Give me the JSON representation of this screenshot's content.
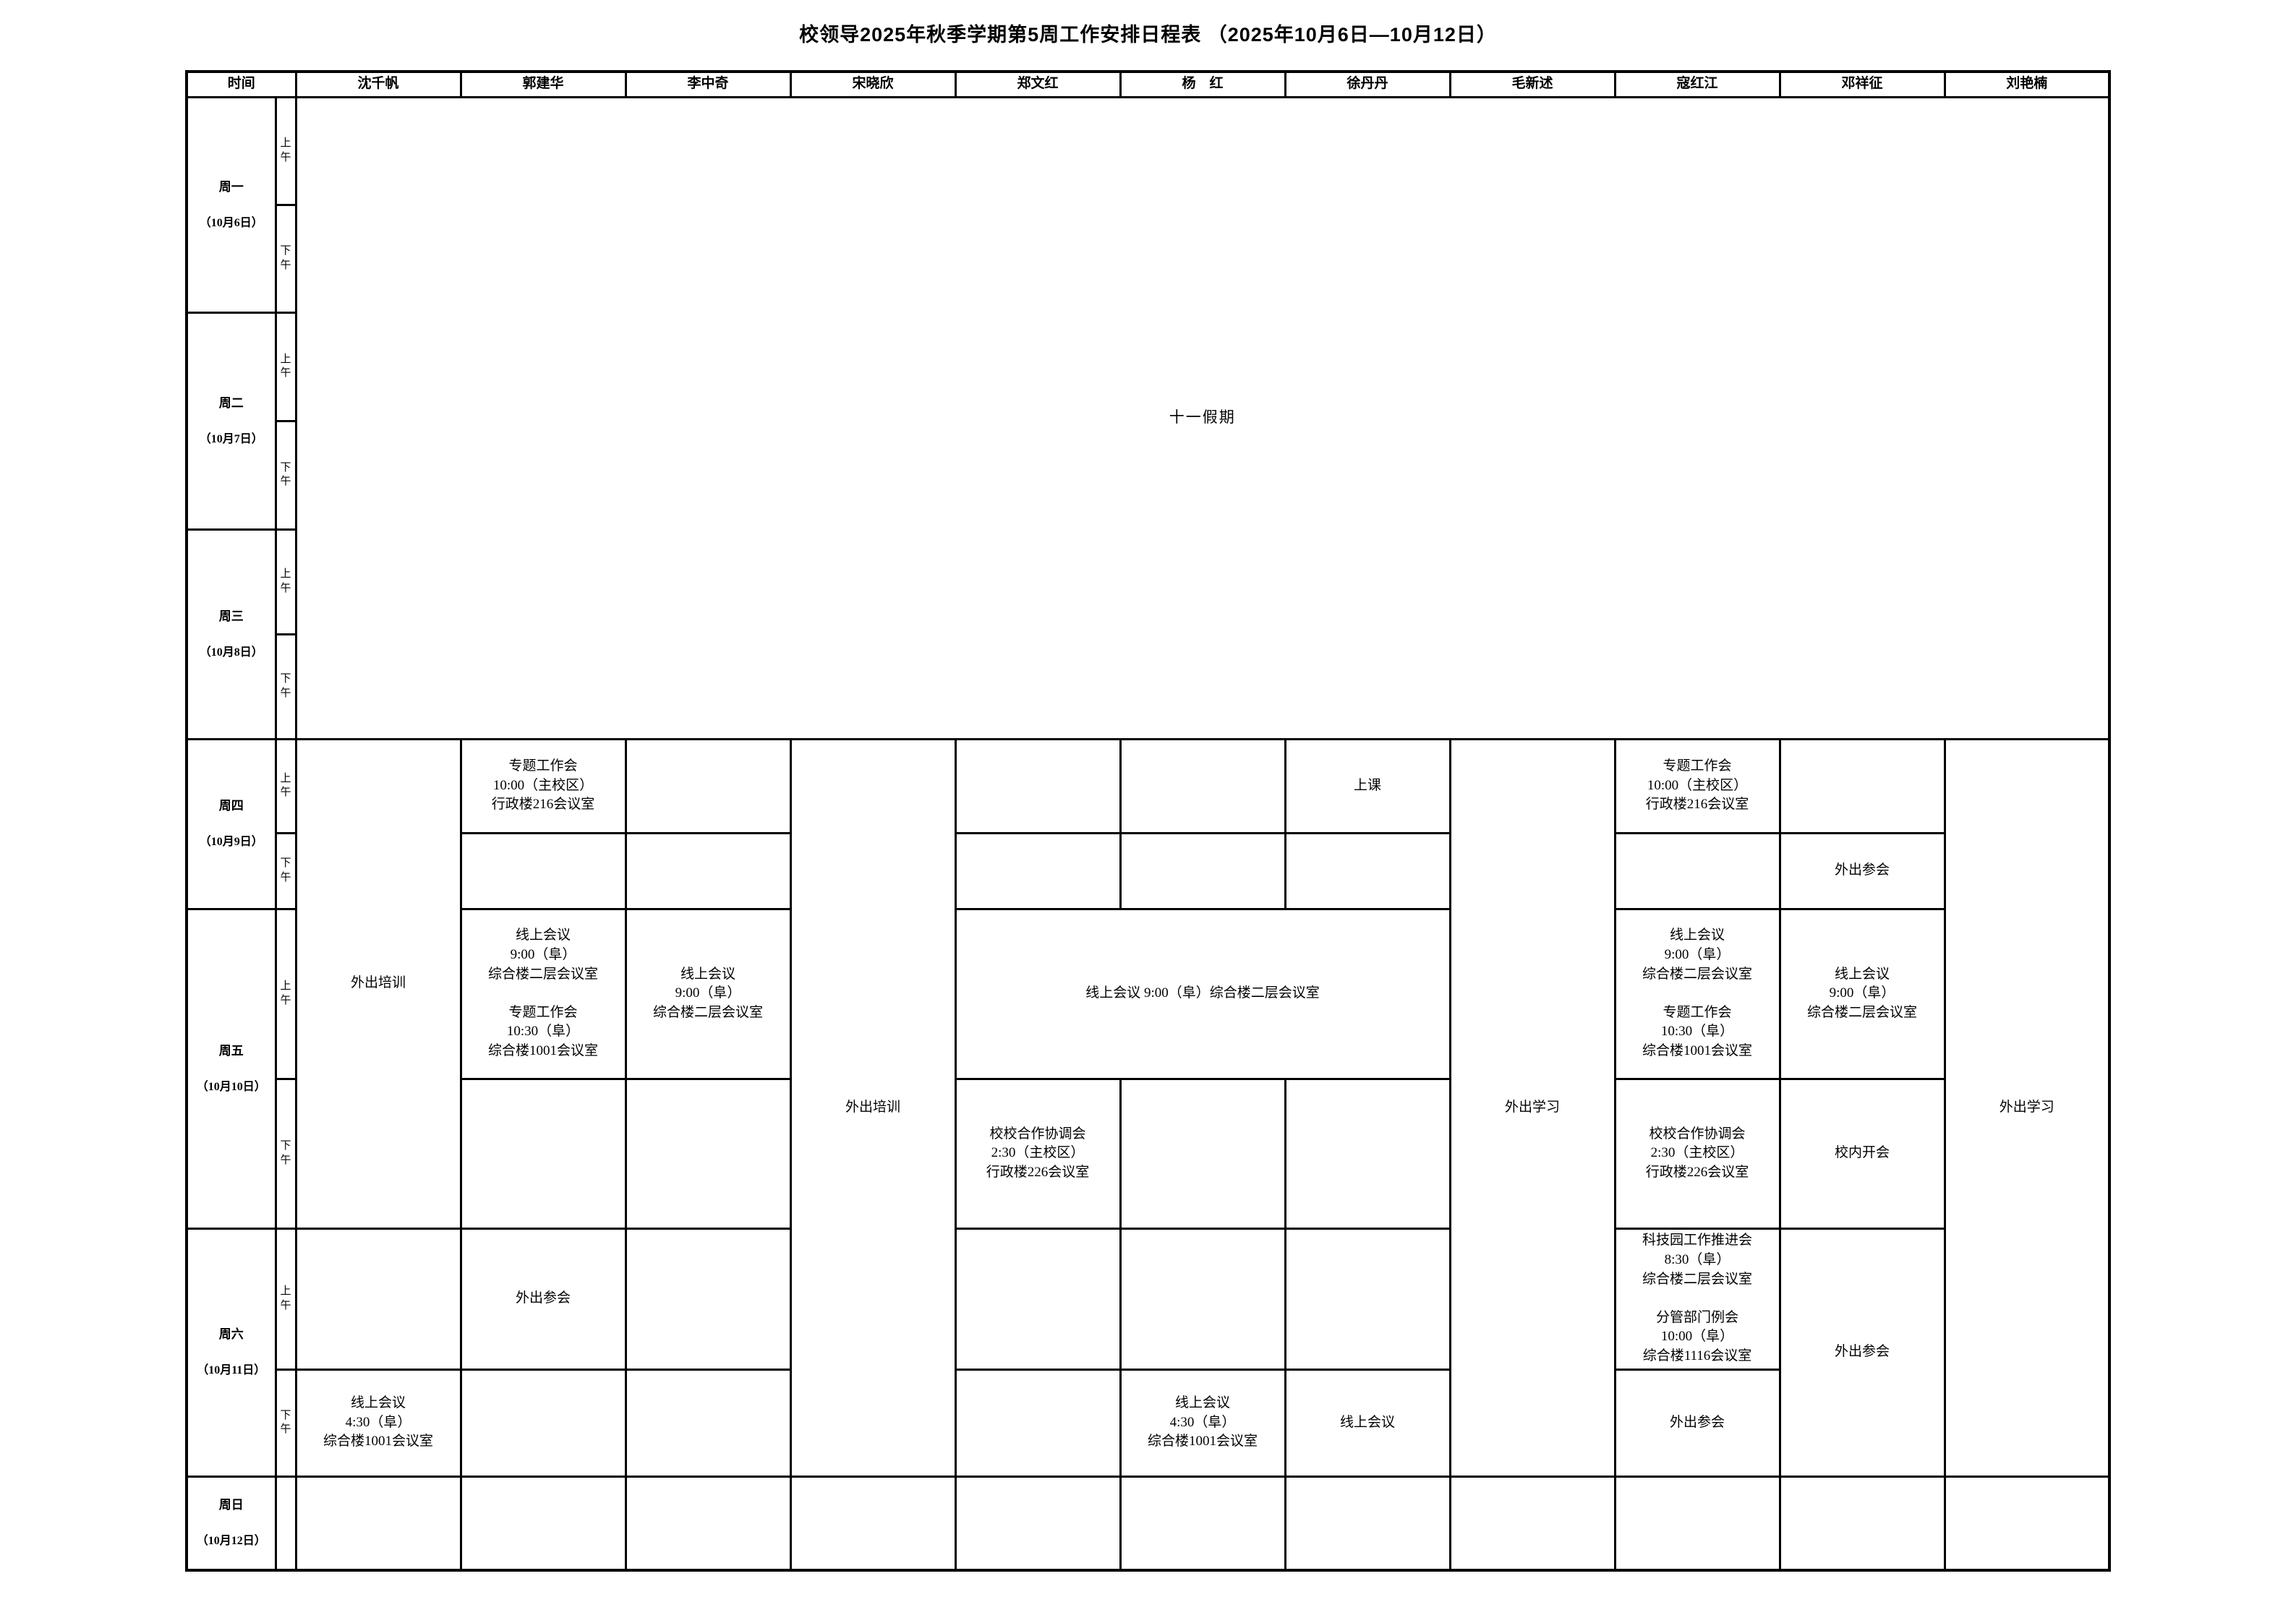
{
  "title": "校领导2025年秋季学期第5周工作安排日程表 （2025年10月6日—10月12日）",
  "header": {
    "time": "时间",
    "people": [
      "沈千帆",
      "郭建华",
      "李中奇",
      "宋晓欣",
      "郑文红",
      "杨　红",
      "徐丹丹",
      "毛新述",
      "寇红江",
      "邓祥征",
      "刘艳楠"
    ]
  },
  "days": [
    {
      "name": "周一",
      "date": "（10月6日）"
    },
    {
      "name": "周二",
      "date": "（10月7日）"
    },
    {
      "name": "周三",
      "date": "（10月8日）"
    },
    {
      "name": "周四",
      "date": "（10月9日）"
    },
    {
      "name": "周五",
      "date": "（10月10日）"
    },
    {
      "name": "周六",
      "date": "（10月11日）"
    },
    {
      "name": "周日",
      "date": "（10月12日）"
    }
  ],
  "periods": {
    "am": "上午",
    "pm": "下午"
  },
  "holiday": "十一假期",
  "cells": {
    "shen_thu_fri": "外出培训",
    "shen_sat_pm": "线上会议\n4:30（阜）\n综合楼1001会议室",
    "guo_thu_am": "专题工作会\n10:00（主校区）\n行政楼216会议室",
    "guo_fri_am": "线上会议\n9:00（阜）\n综合楼二层会议室\n\n专题工作会\n10:30（阜）\n综合楼1001会议室",
    "guo_sat_am": "外出参会",
    "li_fri_am": "线上会议\n9:00（阜）\n综合楼二层会议室",
    "song_thu_sat": "外出培训",
    "zheng_yang_xu_fri_am": "线上会议 9:00（阜）综合楼二层会议室",
    "zheng_fri_pm": "校校合作协调会\n2:30（主校区）\n行政楼226会议室",
    "yang_sat_pm": "线上会议\n4:30（阜）\n综合楼1001会议室",
    "xu_thu_am": "上课",
    "xu_sat_pm": "线上会议",
    "mao_thu_sat": "外出学习",
    "kou_thu_am": "专题工作会\n10:00（主校区）\n行政楼216会议室",
    "kou_fri_am": "线上会议\n9:00（阜）\n综合楼二层会议室\n\n专题工作会\n10:30（阜）\n综合楼1001会议室",
    "kou_fri_pm": "校校合作协调会\n2:30（主校区）\n行政楼226会议室",
    "kou_sat_am": "科技园工作推进会\n8:30（阜）\n综合楼二层会议室\n\n分管部门例会\n10:00（阜）\n综合楼1116会议室",
    "kou_sat_pm": "外出参会",
    "deng_thu_pm": "外出参会",
    "deng_fri_am": "线上会议\n9:00（阜）\n综合楼二层会议室",
    "deng_fri_pm": "校内开会",
    "deng_sat": "外出参会",
    "liu_thu_sat": "外出学习"
  }
}
